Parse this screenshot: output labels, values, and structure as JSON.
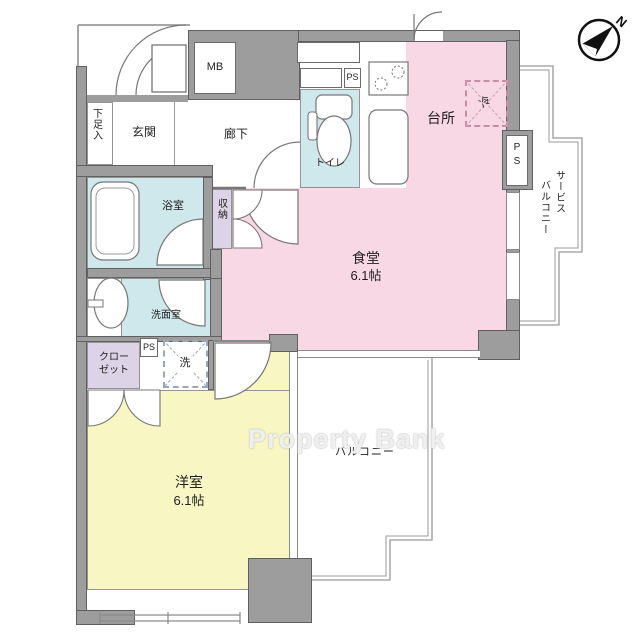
{
  "watermark": "Property Bank",
  "compass": {
    "north": "N"
  },
  "labels": {
    "shoe_storage": "下足入",
    "entrance": "玄関",
    "meter_box": "MB",
    "corridor": "廊下",
    "toilet": "トイレ",
    "ps_hall": "PS",
    "kitchen": "台所",
    "refrigerator": "冷",
    "ps_right": "PS",
    "service_balcony_col_right": "サービス",
    "service_balcony_col_left": "バルコニー",
    "bathroom": "浴室",
    "storage": "収納",
    "dining": "食堂",
    "dining_size": "6.1帖",
    "washroom": "洗面室",
    "closet_line1": "クロー",
    "closet_line2": "ゼット",
    "ps_mid": "PS",
    "washing_machine": "洗",
    "western_room": "洋室",
    "western_room_size": "6.1帖",
    "balcony": "バルコニー"
  },
  "colors": {
    "wall": "#9d9d9d",
    "room_pink": "#f8d8e4",
    "room_blue": "#cfe8ec",
    "room_yellow": "#f8f6c2",
    "room_purple": "#dcd3e6",
    "outline": "#888888"
  }
}
